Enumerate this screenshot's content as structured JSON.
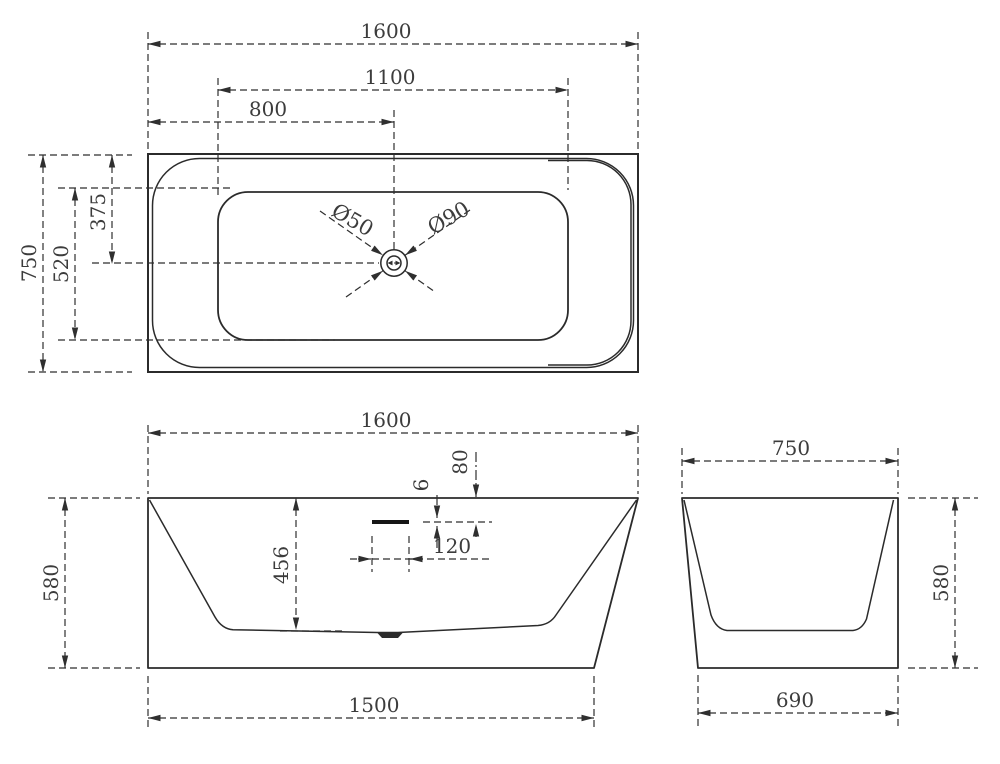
{
  "title": "Bathtub technical drawing - three orthographic views",
  "colors": {
    "line": "#2b2b2b",
    "text": "#3c3c3c",
    "background": "#ffffff"
  },
  "views": {
    "top": {
      "label": "plan view",
      "dims": {
        "overall_length": "1600",
        "inner_length": "1100",
        "drain_offset_x": "800",
        "overall_width": "750",
        "inner_width": "520",
        "drain_offset_y": "375",
        "drain_small": "Ø50",
        "drain_large": "Ø90"
      }
    },
    "front": {
      "label": "front elevation",
      "dims": {
        "overall_length": "1600",
        "rim_to_overflow": "80",
        "overflow_slot_height": "6",
        "overflow_slot_width": "120",
        "basin_depth": "456",
        "overall_height": "580",
        "base_length": "1500"
      }
    },
    "side": {
      "label": "side elevation",
      "dims": {
        "overall_width": "750",
        "overall_height": "580",
        "base_width": "690"
      }
    }
  }
}
